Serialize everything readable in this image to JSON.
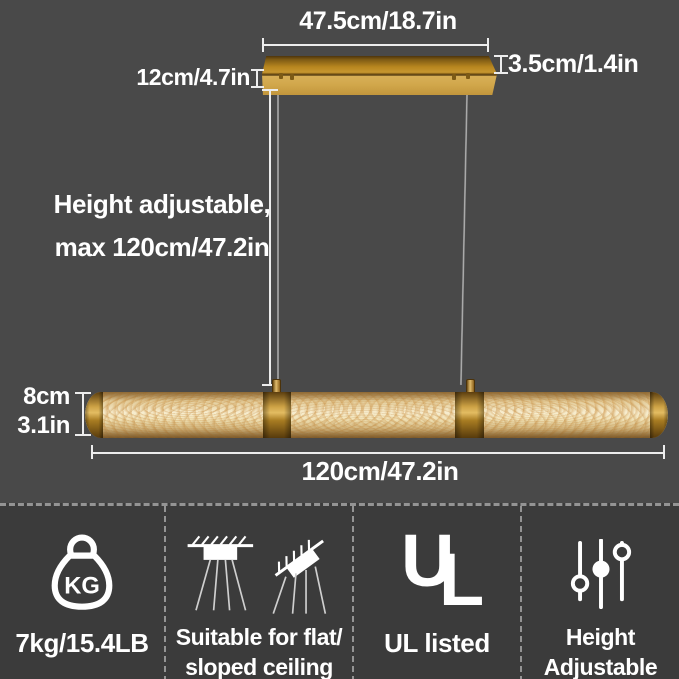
{
  "colors": {
    "background_top": "#494949",
    "background_bottom": "#3b3b3b",
    "brass_gold": "#c79730",
    "alabaster": "#ecd9ad",
    "text": "#ffffff",
    "dashed_divider": "#949494"
  },
  "diagram": {
    "canopy_width_label": "47.5cm/18.7in",
    "canopy_thickness_label": "3.5cm/1.4in",
    "canopy_depth_label": "12cm/4.7in",
    "height_adjustable_line1": "Height adjustable,",
    "height_adjustable_line2": "max 120cm/47.2in",
    "bar_height_cm": "8cm",
    "bar_height_in": "3.1in",
    "bar_length_label": "120cm/47.2in"
  },
  "features": {
    "weight": {
      "badge": "KG",
      "label": "7kg/15.4LB"
    },
    "ceiling": {
      "label_line1": "Suitable for flat/",
      "label_line2": "sloped ceiling"
    },
    "ul": {
      "letter_u": "U",
      "letter_l": "L",
      "label": "UL listed"
    },
    "height": {
      "label_line1": "Height",
      "label_line2": "Adjustable"
    }
  }
}
